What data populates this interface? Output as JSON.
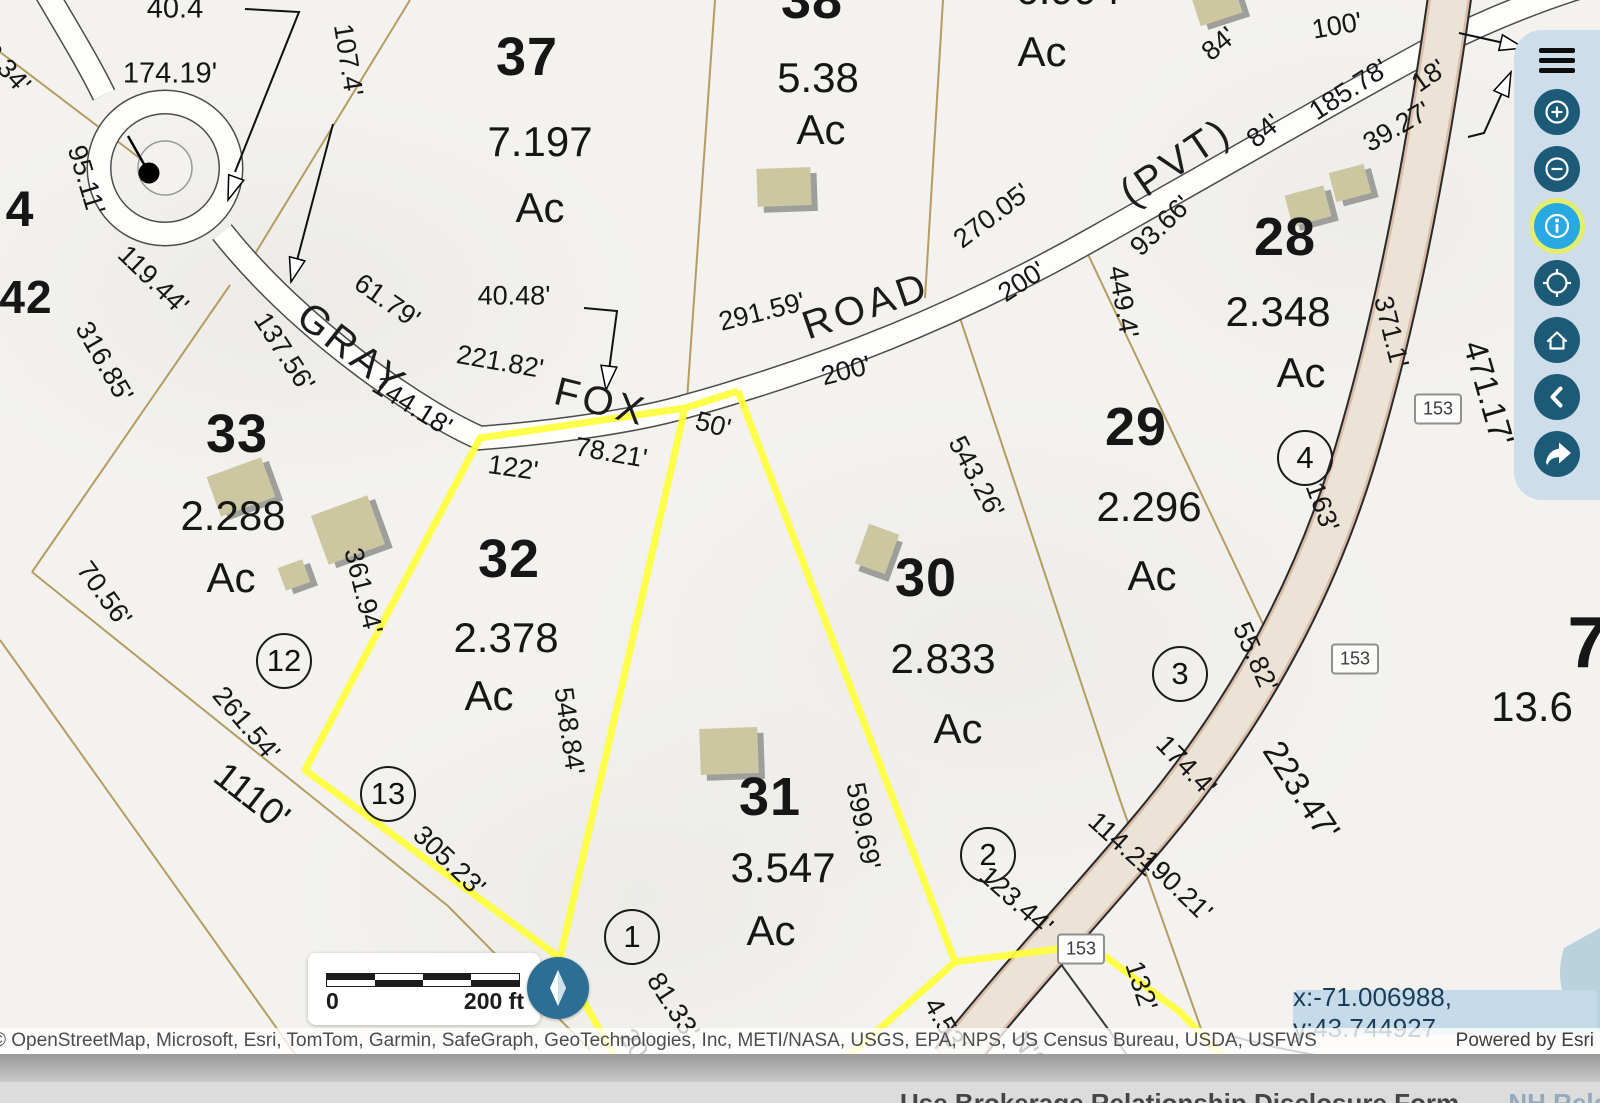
{
  "map": {
    "road_names": [
      {
        "text": "GRAY",
        "x": 352,
        "y": 350,
        "r": 38
      },
      {
        "text": "FOX",
        "x": 601,
        "y": 402,
        "r": 14
      },
      {
        "text": "ROAD",
        "x": 866,
        "y": 306,
        "r": -19
      },
      {
        "text": "(PVT)",
        "x": 1176,
        "y": 162,
        "r": -34
      }
    ],
    "parcel_numbers": [
      {
        "text": "37",
        "x": 527,
        "y": 57
      },
      {
        "text": "38",
        "x": 812,
        "y": 0
      },
      {
        "text": "28",
        "x": 1285,
        "y": 237
      },
      {
        "text": "29",
        "x": 1136,
        "y": 427
      },
      {
        "text": "30",
        "x": 926,
        "y": 578
      },
      {
        "text": "31",
        "x": 770,
        "y": 797
      },
      {
        "text": "32",
        "x": 509,
        "y": 559
      },
      {
        "text": "33",
        "x": 237,
        "y": 434
      },
      {
        "text": "4",
        "x": 20,
        "y": 209,
        "fs": 50
      },
      {
        "text": "42",
        "x": 26,
        "y": 297,
        "fs": 46
      },
      {
        "text": "7",
        "x": 1588,
        "y": 643,
        "fs": 72
      }
    ],
    "acreage_labels": [
      {
        "text": "7.197",
        "x": 540,
        "y": 142
      },
      {
        "text": "Ac",
        "x": 540,
        "y": 208
      },
      {
        "text": "5.38",
        "x": 818,
        "y": 78
      },
      {
        "text": "Ac",
        "x": 821,
        "y": 130
      },
      {
        "text": "6.994",
        "x": 1068,
        "y": -10
      },
      {
        "text": "Ac",
        "x": 1042,
        "y": 52
      },
      {
        "text": "2.348",
        "x": 1278,
        "y": 312
      },
      {
        "text": "Ac",
        "x": 1301,
        "y": 373
      },
      {
        "text": "2.296",
        "x": 1149,
        "y": 507
      },
      {
        "text": "Ac",
        "x": 1152,
        "y": 576
      },
      {
        "text": "2.833",
        "x": 943,
        "y": 659
      },
      {
        "text": "Ac",
        "x": 958,
        "y": 729
      },
      {
        "text": "3.547",
        "x": 783,
        "y": 868
      },
      {
        "text": "Ac",
        "x": 771,
        "y": 931
      },
      {
        "text": "2.378",
        "x": 506,
        "y": 638
      },
      {
        "text": "Ac",
        "x": 489,
        "y": 696
      },
      {
        "text": "2.288",
        "x": 233,
        "y": 516
      },
      {
        "text": "Ac",
        "x": 231,
        "y": 578
      },
      {
        "text": "13.6",
        "x": 1532,
        "y": 707
      }
    ],
    "dimension_labels": [
      {
        "text": "40.4",
        "x": 175,
        "y": 9,
        "fs": 29
      },
      {
        "text": "174.19'",
        "x": 170,
        "y": 74,
        "fs": 29
      },
      {
        "text": "107.4'",
        "x": 348,
        "y": 60,
        "r": 81
      },
      {
        "text": "6.34'",
        "x": 6,
        "y": 68,
        "r": 48
      },
      {
        "text": "95.11'",
        "x": 86,
        "y": 180,
        "r": 73
      },
      {
        "text": "119.44'",
        "x": 153,
        "y": 280,
        "r": 44
      },
      {
        "text": "316.85'",
        "x": 104,
        "y": 362,
        "r": 60
      },
      {
        "text": "137.56'",
        "x": 284,
        "y": 352,
        "r": 57
      },
      {
        "text": "144.18'",
        "x": 412,
        "y": 406,
        "r": 32
      },
      {
        "text": "61.79'",
        "x": 387,
        "y": 301,
        "r": 35
      },
      {
        "text": "221.82'",
        "x": 500,
        "y": 362,
        "r": 10
      },
      {
        "text": "40.48'",
        "x": 514,
        "y": 296
      },
      {
        "text": "291.59'",
        "x": 762,
        "y": 312,
        "r": -14
      },
      {
        "text": "270.05'",
        "x": 992,
        "y": 216,
        "r": -37
      },
      {
        "text": "200'",
        "x": 1022,
        "y": 282,
        "r": -33
      },
      {
        "text": "200'",
        "x": 846,
        "y": 371,
        "r": -14
      },
      {
        "text": "93.66'",
        "x": 1161,
        "y": 226,
        "r": -44
      },
      {
        "text": "84'",
        "x": 1219,
        "y": 44,
        "r": -40
      },
      {
        "text": "84'",
        "x": 1264,
        "y": 131,
        "r": -40
      },
      {
        "text": "185.78'",
        "x": 1349,
        "y": 90,
        "r": -33
      },
      {
        "text": "18'",
        "x": 1429,
        "y": 76,
        "r": -35
      },
      {
        "text": "100'",
        "x": 1337,
        "y": 26,
        "r": -10
      },
      {
        "text": "39.27'",
        "x": 1397,
        "y": 127,
        "r": -30
      },
      {
        "text": "449.4'",
        "x": 1123,
        "y": 302,
        "r": 80
      },
      {
        "text": "371.1'",
        "x": 1391,
        "y": 332,
        "r": 76
      },
      {
        "text": "471.17'",
        "x": 1489,
        "y": 393,
        "r": 74,
        "fs": 33
      },
      {
        "text": "543.26'",
        "x": 976,
        "y": 477,
        "r": 62
      },
      {
        "text": "163'",
        "x": 1322,
        "y": 507,
        "r": 70
      },
      {
        "text": "55.82'",
        "x": 1255,
        "y": 657,
        "r": 66
      },
      {
        "text": "174.4'",
        "x": 1186,
        "y": 766,
        "r": 46
      },
      {
        "text": "114.21'",
        "x": 1124,
        "y": 846,
        "r": 42
      },
      {
        "text": "123.44'",
        "x": 1016,
        "y": 901,
        "r": 42
      },
      {
        "text": "190.21'",
        "x": 1176,
        "y": 886,
        "r": 44
      },
      {
        "text": "223.47'",
        "x": 1301,
        "y": 791,
        "r": 57,
        "fs": 34
      },
      {
        "text": "132'",
        "x": 1141,
        "y": 986,
        "r": 72
      },
      {
        "text": "122'",
        "x": 513,
        "y": 468,
        "r": 8
      },
      {
        "text": "78.21'",
        "x": 611,
        "y": 453,
        "r": 10
      },
      {
        "text": "50'",
        "x": 713,
        "y": 425,
        "r": 15
      },
      {
        "text": "361.94'",
        "x": 363,
        "y": 591,
        "r": 76
      },
      {
        "text": "548.84'",
        "x": 569,
        "y": 731,
        "r": 82
      },
      {
        "text": "261.54'",
        "x": 246,
        "y": 724,
        "r": 50
      },
      {
        "text": "70.56'",
        "x": 104,
        "y": 594,
        "r": 54
      },
      {
        "text": "1110'",
        "x": 252,
        "y": 796,
        "r": 38,
        "fs": 37
      },
      {
        "text": "305.23'",
        "x": 449,
        "y": 861,
        "r": 44
      },
      {
        "text": "599.69'",
        "x": 863,
        "y": 826,
        "r": 79
      },
      {
        "text": "81.33'",
        "x": 673,
        "y": 1006,
        "r": 57
      },
      {
        "text": "203.5'",
        "x": 645,
        "y": 1062,
        "r": 57
      },
      {
        "text": "4.53'",
        "x": 945,
        "y": 1025,
        "r": 60
      },
      {
        "text": "N'S",
        "x": 1030,
        "y": 1052,
        "r": 55
      }
    ],
    "circled_numbers": [
      {
        "text": "12",
        "x": 284,
        "y": 661
      },
      {
        "text": "13",
        "x": 388,
        "y": 794
      },
      {
        "text": "1",
        "x": 632,
        "y": 937
      },
      {
        "text": "2",
        "x": 988,
        "y": 855
      },
      {
        "text": "3",
        "x": 1180,
        "y": 674
      },
      {
        "text": "4",
        "x": 1305,
        "y": 458
      }
    ],
    "route_shields": [
      {
        "text": "153",
        "x": 1438,
        "y": 409
      },
      {
        "text": "153",
        "x": 1355,
        "y": 659
      },
      {
        "text": "153",
        "x": 1081,
        "y": 949
      }
    ],
    "buildings": [
      {
        "x": 757,
        "y": 168,
        "w": 54,
        "h": 38,
        "r": -2
      },
      {
        "x": 1195,
        "y": -10,
        "w": 44,
        "h": 30,
        "r": -18
      },
      {
        "x": 1288,
        "y": 190,
        "w": 40,
        "h": 32,
        "r": -15
      },
      {
        "x": 1332,
        "y": 168,
        "w": 36,
        "h": 30,
        "r": -15
      },
      {
        "x": 212,
        "y": 466,
        "w": 58,
        "h": 42,
        "r": -20
      },
      {
        "x": 318,
        "y": 504,
        "w": 60,
        "h": 52,
        "r": -20
      },
      {
        "x": 281,
        "y": 563,
        "w": 26,
        "h": 24,
        "r": -20
      },
      {
        "x": 861,
        "y": 528,
        "w": 32,
        "h": 42,
        "r": 20
      },
      {
        "x": 700,
        "y": 728,
        "w": 58,
        "h": 46,
        "r": -2
      }
    ],
    "highlight_color": "#feff3c",
    "parcel_line_color": "#b49c62"
  },
  "toolbar": {
    "buttons": [
      {
        "label": "Menu"
      },
      {
        "label": "Zoom in"
      },
      {
        "label": "Zoom out"
      },
      {
        "label": "Identify"
      },
      {
        "label": "Find my location"
      },
      {
        "label": "Default map view"
      },
      {
        "label": "Previous extent"
      },
      {
        "label": "Share"
      }
    ],
    "active_button": "Identify",
    "accent_dark": "#1d5a78",
    "accent_active": "#29a9e1"
  },
  "scalebar": {
    "start": "0",
    "end": "200 ft"
  },
  "compass": {
    "label": "Reset orientation"
  },
  "coordinates": {
    "text": "x:-71.006988, y:43.744927"
  },
  "attribution": {
    "sources": "© OpenStreetMap, Microsoft, Esri, TomTom, Garmin, SafeGraph, GeoTechnologies, Inc, METI/NASA, USGS, EPA, NPS, US Census Bureau, USDA, USFWS",
    "powered_by": "Powered by Esri"
  },
  "page_footer": {
    "link1": "Use Brokerage Relationship Disclosure Form",
    "link2": "NH Relocation"
  }
}
